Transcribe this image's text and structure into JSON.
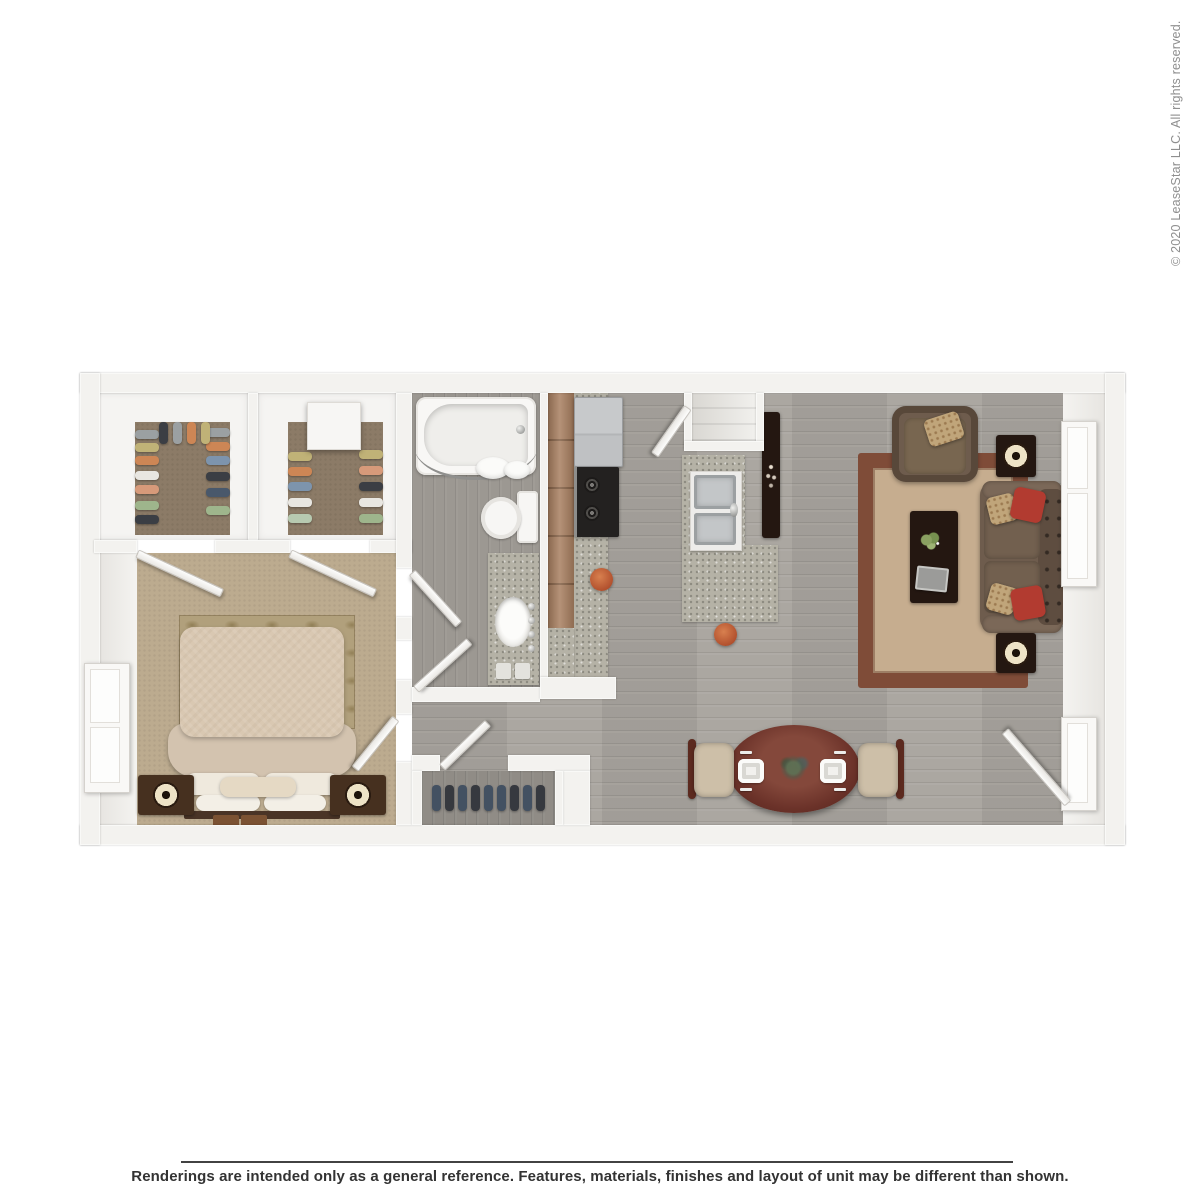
{
  "page": {
    "copyright": "© 2020 LeaseStar LLC. All rights reserved.",
    "disclaimer": "Renderings are intended only as a general reference. Features, materials, finishes and layout of unit may be different than shown."
  },
  "floorplan": {
    "type": "3d-top-down-apartment-rendering",
    "rooms": [
      "bedroom",
      "closet",
      "second-closet",
      "bathroom",
      "hallway",
      "entry-coat-closet",
      "kitchen",
      "pantry",
      "living-room",
      "dining-area"
    ],
    "furniture": [
      "bed",
      "nightstands",
      "table-lamps",
      "bathtub",
      "shower-curtain",
      "toilet",
      "vanity-sink",
      "refrigerator",
      "stove",
      "double-kitchen-sink",
      "kitchen-island",
      "bar-stools",
      "sofa",
      "armchair",
      "coffee-table",
      "end-tables",
      "area-rug",
      "dining-table",
      "dining-chairs",
      "tv-console",
      "hanging-clothes",
      "storage-box"
    ]
  },
  "colors": {
    "wall": "#f3f2ef",
    "wood_floor": "#a7a39d",
    "bath_floor": "#9c9892",
    "granite": "#b5b2a6",
    "bedroom_carpet": "#bcab8f",
    "closet_carpet": "#8c7b67",
    "cabinet": "#a87f60",
    "dark_table": "#241711",
    "bed": "#d9c8b2",
    "nightstand": "#46301f",
    "lamp": "#eee3c6",
    "rug_center": "#c6ad8f",
    "rug_border": "#7f4c38",
    "sofa": "#6e5c4d",
    "red": "#b23b30",
    "gold": "#c0a57a",
    "chair": "#cdbfa8",
    "stool": "#b2512e",
    "dining_table": "#6b3229",
    "copyright": "#8f8f8f",
    "text": "#333333"
  }
}
